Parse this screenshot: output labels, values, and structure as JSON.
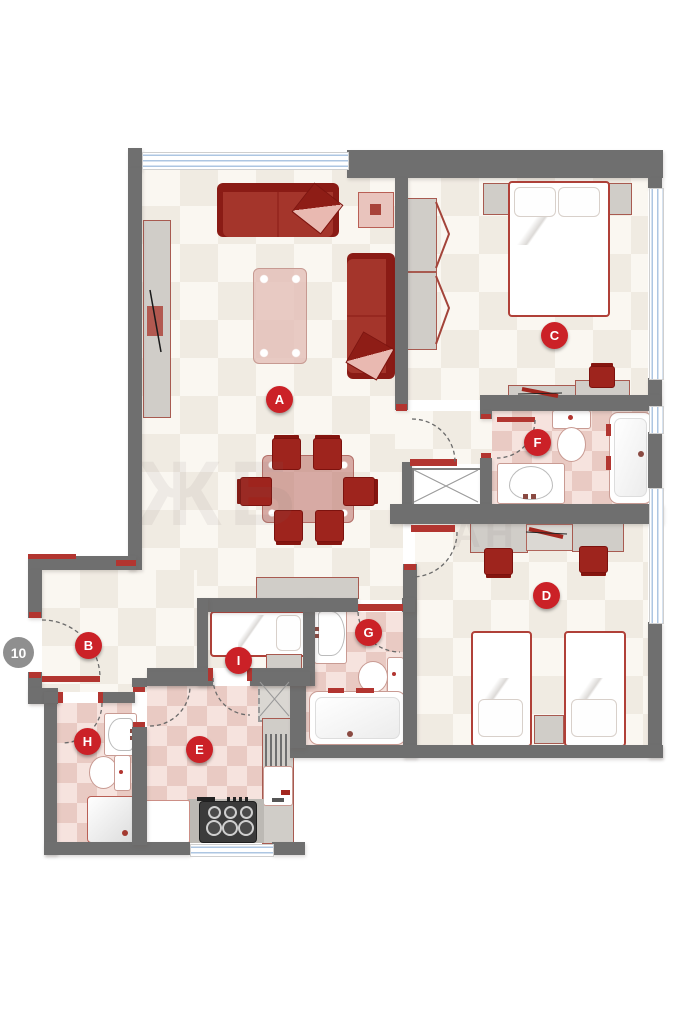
{
  "badge": {
    "number": "10"
  },
  "rooms": [
    {
      "letter": "A",
      "name": "living-dining-room"
    },
    {
      "letter": "B",
      "name": "entry-hall"
    },
    {
      "letter": "C",
      "name": "bedroom-double"
    },
    {
      "letter": "D",
      "name": "bedroom-twin"
    },
    {
      "letter": "E",
      "name": "kitchen"
    },
    {
      "letter": "F",
      "name": "bathroom"
    },
    {
      "letter": "G",
      "name": "bathroom"
    },
    {
      "letter": "H",
      "name": "shower-room"
    },
    {
      "letter": "I",
      "name": "bedroom-single"
    }
  ],
  "watermark": {
    "left": "ЖБ",
    "right": "АН"
  },
  "colors": {
    "wall": "#6f6f6f",
    "marker_red": "#cb2127",
    "badge_gray": "#8f8f8f",
    "furniture_red": "#a4352b",
    "furniture_dark_red": "#85150f",
    "floor_cream": "#faf7f1",
    "floor_cream_check": "#f0ebe2",
    "tile_pink": "#f6e3de",
    "tile_pink_check": "#e9cac3",
    "window_blue": "#adc6e2",
    "door_accent": "#b23530",
    "fixture_gray": "#d0cdc8"
  }
}
